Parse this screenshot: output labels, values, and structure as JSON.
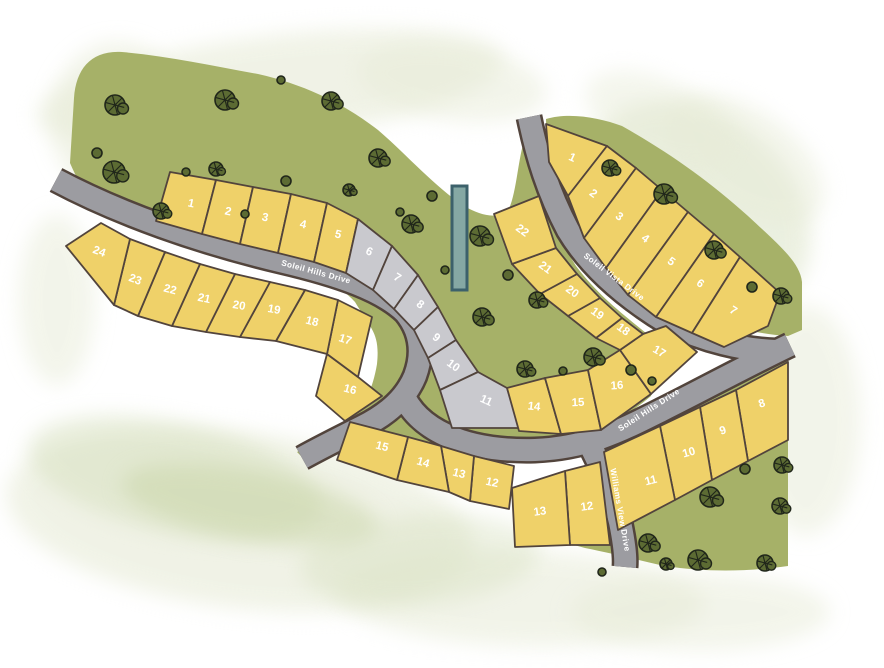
{
  "map": {
    "title": "Soleil Hills subdivision plat map",
    "width": 884,
    "height": 668,
    "colors": {
      "background": "#ffffff",
      "lot_yellow": "#efd169",
      "lot_gray": "#c9c9ce",
      "lot_outline": "#52443c",
      "road_fill": "#9c9ca1",
      "road_outline": "#52443c",
      "green": "#a6b168",
      "tree_fill": "#5c6b33",
      "tree_dark": "#20261a",
      "label_text": "#ffffff",
      "marker_fill": "#85a8a4",
      "marker_outline": "#3c616b",
      "wash_light": "#e7ebd7",
      "wash_mid": "#d5dfbd",
      "wash_sage": "#c8d4a6"
    },
    "green_areas": [
      "M 70,163 L 74,98 C 76,68 92,50 122,52 C 168,56 214,66 258,74 C 302,84 342,102 378,130 C 404,152 434,186 464,206 C 482,216 498,220 509,209 C 517,190 518,158 525,138 L 533,140 C 538,184 553,230 576,266 C 600,298 628,318 652,338 L 661,352 L 651,396 C 628,416 596,434 540,452 C 506,460 478,460 420,452 C 400,448 388,442 380,440 C 370,442 360,444 350,447 L 308,463 L 297,452 L 338,430 C 360,416 372,394 377,364 C 380,334 372,330 355,302 C 338,282 300,270 268,262 C 220,250 160,232 112,212 C 96,205 84,196 70,163 Z",
      "M 546,119 C 570,112 600,118 622,126 C 668,152 708,180 748,216 C 778,244 800,262 802,282 L 802,330 L 788,336 C 758,334 726,326 700,318 C 664,306 634,286 610,262 C 586,236 568,206 556,176 C 550,156 546,136 546,119 Z",
      "M 600,450 L 788,355 L 788,566 C 745,572 705,572 665,566 C 638,560 615,554 585,548 L 574,545 L 580,520 C 586,498 592,472 600,450 Z"
    ],
    "washes": [
      {
        "cx": 270,
        "cy": 88,
        "rx": 235,
        "ry": 52,
        "rot": -7,
        "fill": "wash_light",
        "op": 0.6
      },
      {
        "cx": 118,
        "cy": 120,
        "rx": 68,
        "ry": 78,
        "rot": 0,
        "fill": "wash_light",
        "op": 0.55
      },
      {
        "cx": 452,
        "cy": 82,
        "rx": 95,
        "ry": 38,
        "rot": 8,
        "fill": "wash_light",
        "op": 0.5
      },
      {
        "cx": 700,
        "cy": 205,
        "rx": 125,
        "ry": 88,
        "rot": 40,
        "fill": "wash_mid",
        "op": 0.45
      },
      {
        "cx": 745,
        "cy": 160,
        "rx": 90,
        "ry": 50,
        "rot": 35,
        "fill": "wash_light",
        "op": 0.5
      },
      {
        "cx": 806,
        "cy": 420,
        "rx": 55,
        "ry": 115,
        "rot": 0,
        "fill": "wash_light",
        "op": 0.5
      },
      {
        "cx": 240,
        "cy": 520,
        "rx": 235,
        "ry": 88,
        "rot": 7,
        "fill": "wash_light",
        "op": 0.6
      },
      {
        "cx": 175,
        "cy": 478,
        "rx": 150,
        "ry": 55,
        "rot": 12,
        "fill": "wash_mid",
        "op": 0.5
      },
      {
        "cx": 250,
        "cy": 505,
        "rx": 130,
        "ry": 35,
        "rot": 10,
        "fill": "wash_sage",
        "op": 0.5
      },
      {
        "cx": 520,
        "cy": 598,
        "rx": 185,
        "ry": 48,
        "rot": 2,
        "fill": "wash_light",
        "op": 0.55
      },
      {
        "cx": 700,
        "cy": 612,
        "rx": 130,
        "ry": 38,
        "rot": 0,
        "fill": "wash_light",
        "op": 0.5
      },
      {
        "cx": 57,
        "cy": 300,
        "rx": 38,
        "ry": 85,
        "rot": 0,
        "fill": "wash_light",
        "op": 0.5
      },
      {
        "cx": 420,
        "cy": 560,
        "rx": 120,
        "ry": 45,
        "rot": -5,
        "fill": "wash_mid",
        "op": 0.4
      },
      {
        "cx": 660,
        "cy": 120,
        "rx": 80,
        "ry": 40,
        "rot": 25,
        "fill": "wash_light",
        "op": 0.45
      }
    ],
    "streets": [
      {
        "id": "soleil-hills-drive",
        "name": "Soleil Hills Drive",
        "paths": [
          "M 56,180 C 120,214 200,242 280,261 C 340,275 382,290 405,312 C 420,330 424,352 415,376 C 406,398 388,414 362,427 C 342,437 320,448 302,458",
          "M 402,392 C 416,428 462,452 535,450 C 588,448 622,430 662,410 C 706,388 752,363 790,345"
        ],
        "labels": [
          {
            "x": 316,
            "y": 272,
            "rot": 15
          },
          {
            "x": 649,
            "y": 410,
            "rot": -33
          }
        ]
      },
      {
        "id": "soleil-vista-drive",
        "name": "Soleil Vista Drive",
        "paths": [
          "M 529,117 C 537,156 548,192 568,230 C 592,270 630,300 668,323 C 704,341 744,350 776,351"
        ],
        "labels": [
          {
            "x": 614,
            "y": 277,
            "rot": 37
          }
        ]
      },
      {
        "id": "williams-view-drive",
        "name": "Williams View Drive",
        "paths": [
          "M 588,441 C 602,468 614,496 620,522 C 624,542 626,556 625,567"
        ],
        "labels": [
          {
            "x": 620,
            "y": 510,
            "rot": 80
          }
        ]
      }
    ],
    "clusters": [
      {
        "id": "west",
        "lots": [
          {
            "number": "1",
            "fill": "yellow",
            "points": "170,172 216,180 202,234 156,221",
            "lx": 191,
            "ly": 204,
            "rot": 12
          },
          {
            "number": "2",
            "fill": "yellow",
            "points": "216,180 253,187 240,244 202,234",
            "lx": 228,
            "ly": 212,
            "rot": 12
          },
          {
            "number": "3",
            "fill": "yellow",
            "points": "253,187 291,194 278,253 240,244",
            "lx": 265,
            "ly": 218,
            "rot": 12
          },
          {
            "number": "4",
            "fill": "yellow",
            "points": "291,194 327,203 314,262 278,253",
            "lx": 303,
            "ly": 225,
            "rot": 12
          },
          {
            "number": "5",
            "fill": "yellow",
            "points": "327,203 358,219 346,273 314,262",
            "lx": 338,
            "ly": 235,
            "rot": 14
          },
          {
            "number": "6",
            "fill": "gray",
            "points": "358,219 392,246 373,290 346,273",
            "lx": 369,
            "ly": 252,
            "rot": 24
          },
          {
            "number": "7",
            "fill": "gray",
            "points": "392,246 418,275 394,309 373,290",
            "lx": 397,
            "ly": 278,
            "rot": 32
          },
          {
            "number": "8",
            "fill": "gray",
            "points": "418,275 438,307 414,330 394,309",
            "lx": 420,
            "ly": 305,
            "rot": 36
          },
          {
            "number": "9",
            "fill": "gray",
            "points": "438,307 456,340 428,358 414,330",
            "lx": 436,
            "ly": 338,
            "rot": 38
          },
          {
            "number": "10",
            "fill": "gray",
            "points": "456,340 478,372 440,390 428,358",
            "lx": 453,
            "ly": 366,
            "rot": 36
          },
          {
            "number": "11",
            "fill": "gray",
            "points": "478,372 507,388 520,428 452,428 440,390",
            "lx": 486,
            "ly": 401,
            "rot": 24
          },
          {
            "number": "12",
            "fill": "yellow",
            "points": "474,456 514,466 509,509 470,501",
            "lx": 492,
            "ly": 483,
            "rot": 12
          },
          {
            "number": "13",
            "fill": "yellow",
            "points": "441,446 474,456 470,501 449,492",
            "lx": 459,
            "ly": 474,
            "rot": 14
          },
          {
            "number": "14",
            "fill": "yellow",
            "points": "408,437 441,446 449,492 397,480",
            "lx": 423,
            "ly": 463,
            "rot": 16
          },
          {
            "number": "15",
            "fill": "yellow",
            "points": "350,422 408,437 397,480 337,460",
            "lx": 382,
            "ly": 447,
            "rot": 14
          },
          {
            "number": "16",
            "fill": "yellow",
            "points": "327,354 358,377 382,396 345,421 316,396",
            "lx": 350,
            "ly": 390,
            "rot": 14
          },
          {
            "number": "17",
            "fill": "yellow",
            "points": "338,300 372,317 358,377 327,354",
            "lx": 345,
            "ly": 340,
            "rot": 18
          },
          {
            "number": "18",
            "fill": "yellow",
            "points": "305,290 338,300 327,354 276,341",
            "lx": 312,
            "ly": 322,
            "rot": 14
          },
          {
            "number": "19",
            "fill": "yellow",
            "points": "270,282 305,290 276,341 240,337",
            "lx": 274,
            "ly": 310,
            "rot": 10
          },
          {
            "number": "20",
            "fill": "yellow",
            "points": "235,274 270,282 240,337 206,332",
            "lx": 239,
            "ly": 306,
            "rot": 10
          },
          {
            "number": "21",
            "fill": "yellow",
            "points": "200,264 235,274 206,332 172,326",
            "lx": 204,
            "ly": 299,
            "rot": 12
          },
          {
            "number": "22",
            "fill": "yellow",
            "points": "165,252 200,264 172,326 138,316",
            "lx": 170,
            "ly": 290,
            "rot": 15
          },
          {
            "number": "23",
            "fill": "yellow",
            "points": "130,239 165,252 138,316 114,305",
            "lx": 135,
            "ly": 280,
            "rot": 20
          },
          {
            "number": "24",
            "fill": "yellow",
            "points": "101,223 130,239 114,305 66,246",
            "lx": 99,
            "ly": 252,
            "rot": 20
          }
        ]
      },
      {
        "id": "east",
        "lots": [
          {
            "number": "1",
            "fill": "yellow",
            "points": "546,124 607,146 568,196 549,162",
            "lx": 572,
            "ly": 158,
            "rot": 24
          },
          {
            "number": "2",
            "fill": "yellow",
            "points": "607,146 636,168 584,238 568,196",
            "lx": 593,
            "ly": 194,
            "rot": 36
          },
          {
            "number": "3",
            "fill": "yellow",
            "points": "636,168 662,190 606,268 584,238",
            "lx": 619,
            "ly": 217,
            "rot": 36
          },
          {
            "number": "4",
            "fill": "yellow",
            "points": "662,190 688,212 628,295 606,268",
            "lx": 645,
            "ly": 239,
            "rot": 36
          },
          {
            "number": "5",
            "fill": "yellow",
            "points": "688,212 714,234 656,317 628,295",
            "lx": 671,
            "ly": 262,
            "rot": 36
          },
          {
            "number": "6",
            "fill": "yellow",
            "points": "714,234 740,257 692,333 656,317",
            "lx": 700,
            "ly": 284,
            "rot": 36
          },
          {
            "number": "7",
            "fill": "yellow",
            "points": "740,257 780,293 768,326 724,347 692,333",
            "lx": 733,
            "ly": 311,
            "rot": 32
          },
          {
            "number": "8",
            "fill": "yellow",
            "points": "736,390 788,362 788,440 748,461",
            "lx": 762,
            "ly": 404,
            "rot": -18
          },
          {
            "number": "9",
            "fill": "yellow",
            "points": "700,407 736,390 748,461 712,480",
            "lx": 723,
            "ly": 431,
            "rot": -18
          },
          {
            "number": "10",
            "fill": "yellow",
            "points": "660,426 700,407 712,480 675,500",
            "lx": 689,
            "ly": 453,
            "rot": -16
          },
          {
            "number": "11",
            "fill": "yellow",
            "points": "604,452 660,426 675,500 618,530",
            "lx": 651,
            "ly": 481,
            "rot": -14
          },
          {
            "number": "12",
            "fill": "yellow",
            "points": "565,471 600,462 610,545 570,545",
            "lx": 587,
            "ly": 507,
            "rot": -8
          },
          {
            "number": "13",
            "fill": "yellow",
            "points": "512,488 565,471 570,545 515,547",
            "lx": 540,
            "ly": 512,
            "rot": -8
          },
          {
            "number": "14",
            "fill": "yellow",
            "points": "507,388 545,378 561,434 519,431",
            "lx": 534,
            "ly": 407,
            "rot": 6
          },
          {
            "number": "15",
            "fill": "yellow",
            "points": "545,378 588,370 601,430 561,434",
            "lx": 578,
            "ly": 403,
            "rot": -2
          },
          {
            "number": "16",
            "fill": "yellow",
            "points": "588,370 620,350 651,394 601,430",
            "lx": 617,
            "ly": 386,
            "rot": -4
          },
          {
            "number": "17",
            "fill": "yellow",
            "points": "643,334 620,350 651,394 697,352 666,326",
            "lx": 659,
            "ly": 352,
            "rot": 30
          },
          {
            "number": "18",
            "fill": "yellow",
            "points": "622,318 643,334 620,350 596,338",
            "lx": 623,
            "ly": 330,
            "rot": 36
          },
          {
            "number": "19",
            "fill": "yellow",
            "points": "600,298 622,318 596,338 568,316",
            "lx": 597,
            "ly": 314,
            "rot": 36
          },
          {
            "number": "20",
            "fill": "yellow",
            "points": "577,274 600,298 568,316 540,294",
            "lx": 572,
            "ly": 292,
            "rot": 36
          },
          {
            "number": "21",
            "fill": "yellow",
            "points": "556,248 577,274 540,294 512,264",
            "lx": 545,
            "ly": 268,
            "rot": 36
          },
          {
            "number": "22",
            "fill": "yellow",
            "points": "494,214 539,196 556,248 512,264",
            "lx": 522,
            "ly": 231,
            "rot": 36
          }
        ]
      }
    ],
    "marker": {
      "x": 452,
      "y": 186,
      "width": 15,
      "height": 104
    },
    "trees": [
      {
        "x": 115,
        "y": 105,
        "r": 10
      },
      {
        "x": 225,
        "y": 100,
        "r": 10
      },
      {
        "x": 281,
        "y": 80,
        "r": 4
      },
      {
        "x": 331,
        "y": 101,
        "r": 9
      },
      {
        "x": 97,
        "y": 153,
        "r": 5
      },
      {
        "x": 114,
        "y": 172,
        "r": 11
      },
      {
        "x": 161,
        "y": 211,
        "r": 8
      },
      {
        "x": 216,
        "y": 169,
        "r": 7
      },
      {
        "x": 186,
        "y": 172,
        "r": 4
      },
      {
        "x": 286,
        "y": 181,
        "r": 5
      },
      {
        "x": 349,
        "y": 190,
        "r": 6
      },
      {
        "x": 378,
        "y": 158,
        "r": 9
      },
      {
        "x": 245,
        "y": 214,
        "r": 4
      },
      {
        "x": 400,
        "y": 212,
        "r": 4
      },
      {
        "x": 411,
        "y": 224,
        "r": 9
      },
      {
        "x": 432,
        "y": 196,
        "r": 5
      },
      {
        "x": 480,
        "y": 236,
        "r": 10
      },
      {
        "x": 445,
        "y": 270,
        "r": 4
      },
      {
        "x": 508,
        "y": 275,
        "r": 5
      },
      {
        "x": 482,
        "y": 317,
        "r": 9
      },
      {
        "x": 537,
        "y": 300,
        "r": 8
      },
      {
        "x": 525,
        "y": 369,
        "r": 8
      },
      {
        "x": 563,
        "y": 371,
        "r": 4
      },
      {
        "x": 593,
        "y": 357,
        "r": 9
      },
      {
        "x": 631,
        "y": 370,
        "r": 5
      },
      {
        "x": 652,
        "y": 381,
        "r": 4
      },
      {
        "x": 610,
        "y": 168,
        "r": 8
      },
      {
        "x": 664,
        "y": 194,
        "r": 10
      },
      {
        "x": 714,
        "y": 250,
        "r": 9
      },
      {
        "x": 752,
        "y": 287,
        "r": 5
      },
      {
        "x": 781,
        "y": 296,
        "r": 8
      },
      {
        "x": 710,
        "y": 497,
        "r": 10
      },
      {
        "x": 745,
        "y": 469,
        "r": 5
      },
      {
        "x": 782,
        "y": 465,
        "r": 8
      },
      {
        "x": 780,
        "y": 506,
        "r": 8
      },
      {
        "x": 648,
        "y": 543,
        "r": 9
      },
      {
        "x": 698,
        "y": 560,
        "r": 10
      },
      {
        "x": 666,
        "y": 564,
        "r": 6
      },
      {
        "x": 765,
        "y": 563,
        "r": 8
      },
      {
        "x": 602,
        "y": 572,
        "r": 4
      }
    ]
  }
}
